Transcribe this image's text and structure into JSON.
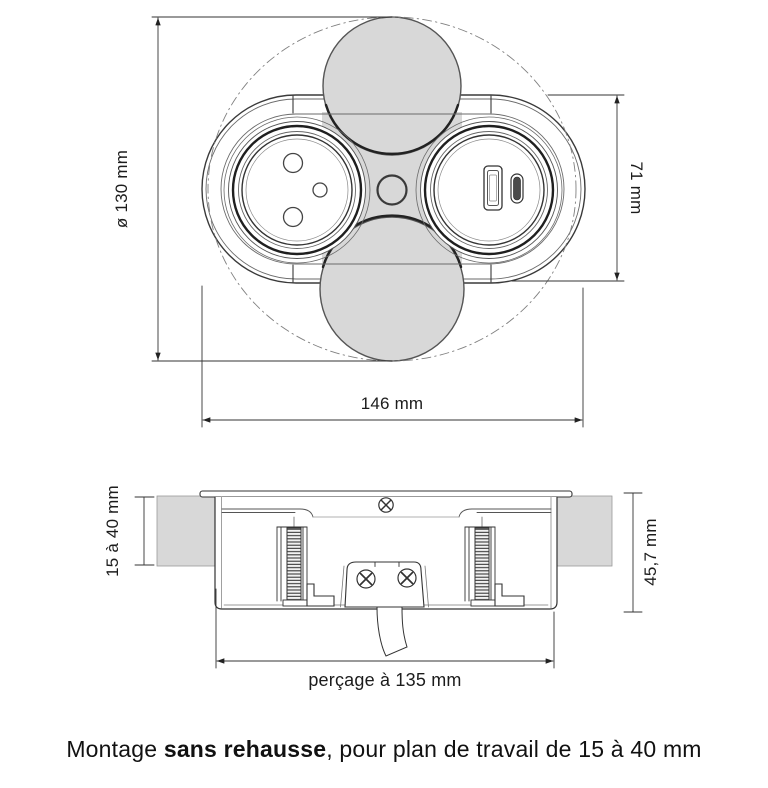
{
  "top_view": {
    "diameter_label": "ø 130 mm",
    "height_label": "71 mm",
    "width_label": "146 mm"
  },
  "side_view": {
    "worktop_thickness_label": "15 à 40 mm",
    "unit_height_label": "45,7 mm",
    "drill_label": "perçage à 135 mm"
  },
  "caption": {
    "prefix": "Montage ",
    "emphasis": "sans rehausse",
    "suffix": ", pour plan de travail de 15 à 40 mm"
  },
  "colors": {
    "line": "#2f2f2f",
    "gray_fill": "#d8d8d8",
    "text": "#111111"
  }
}
